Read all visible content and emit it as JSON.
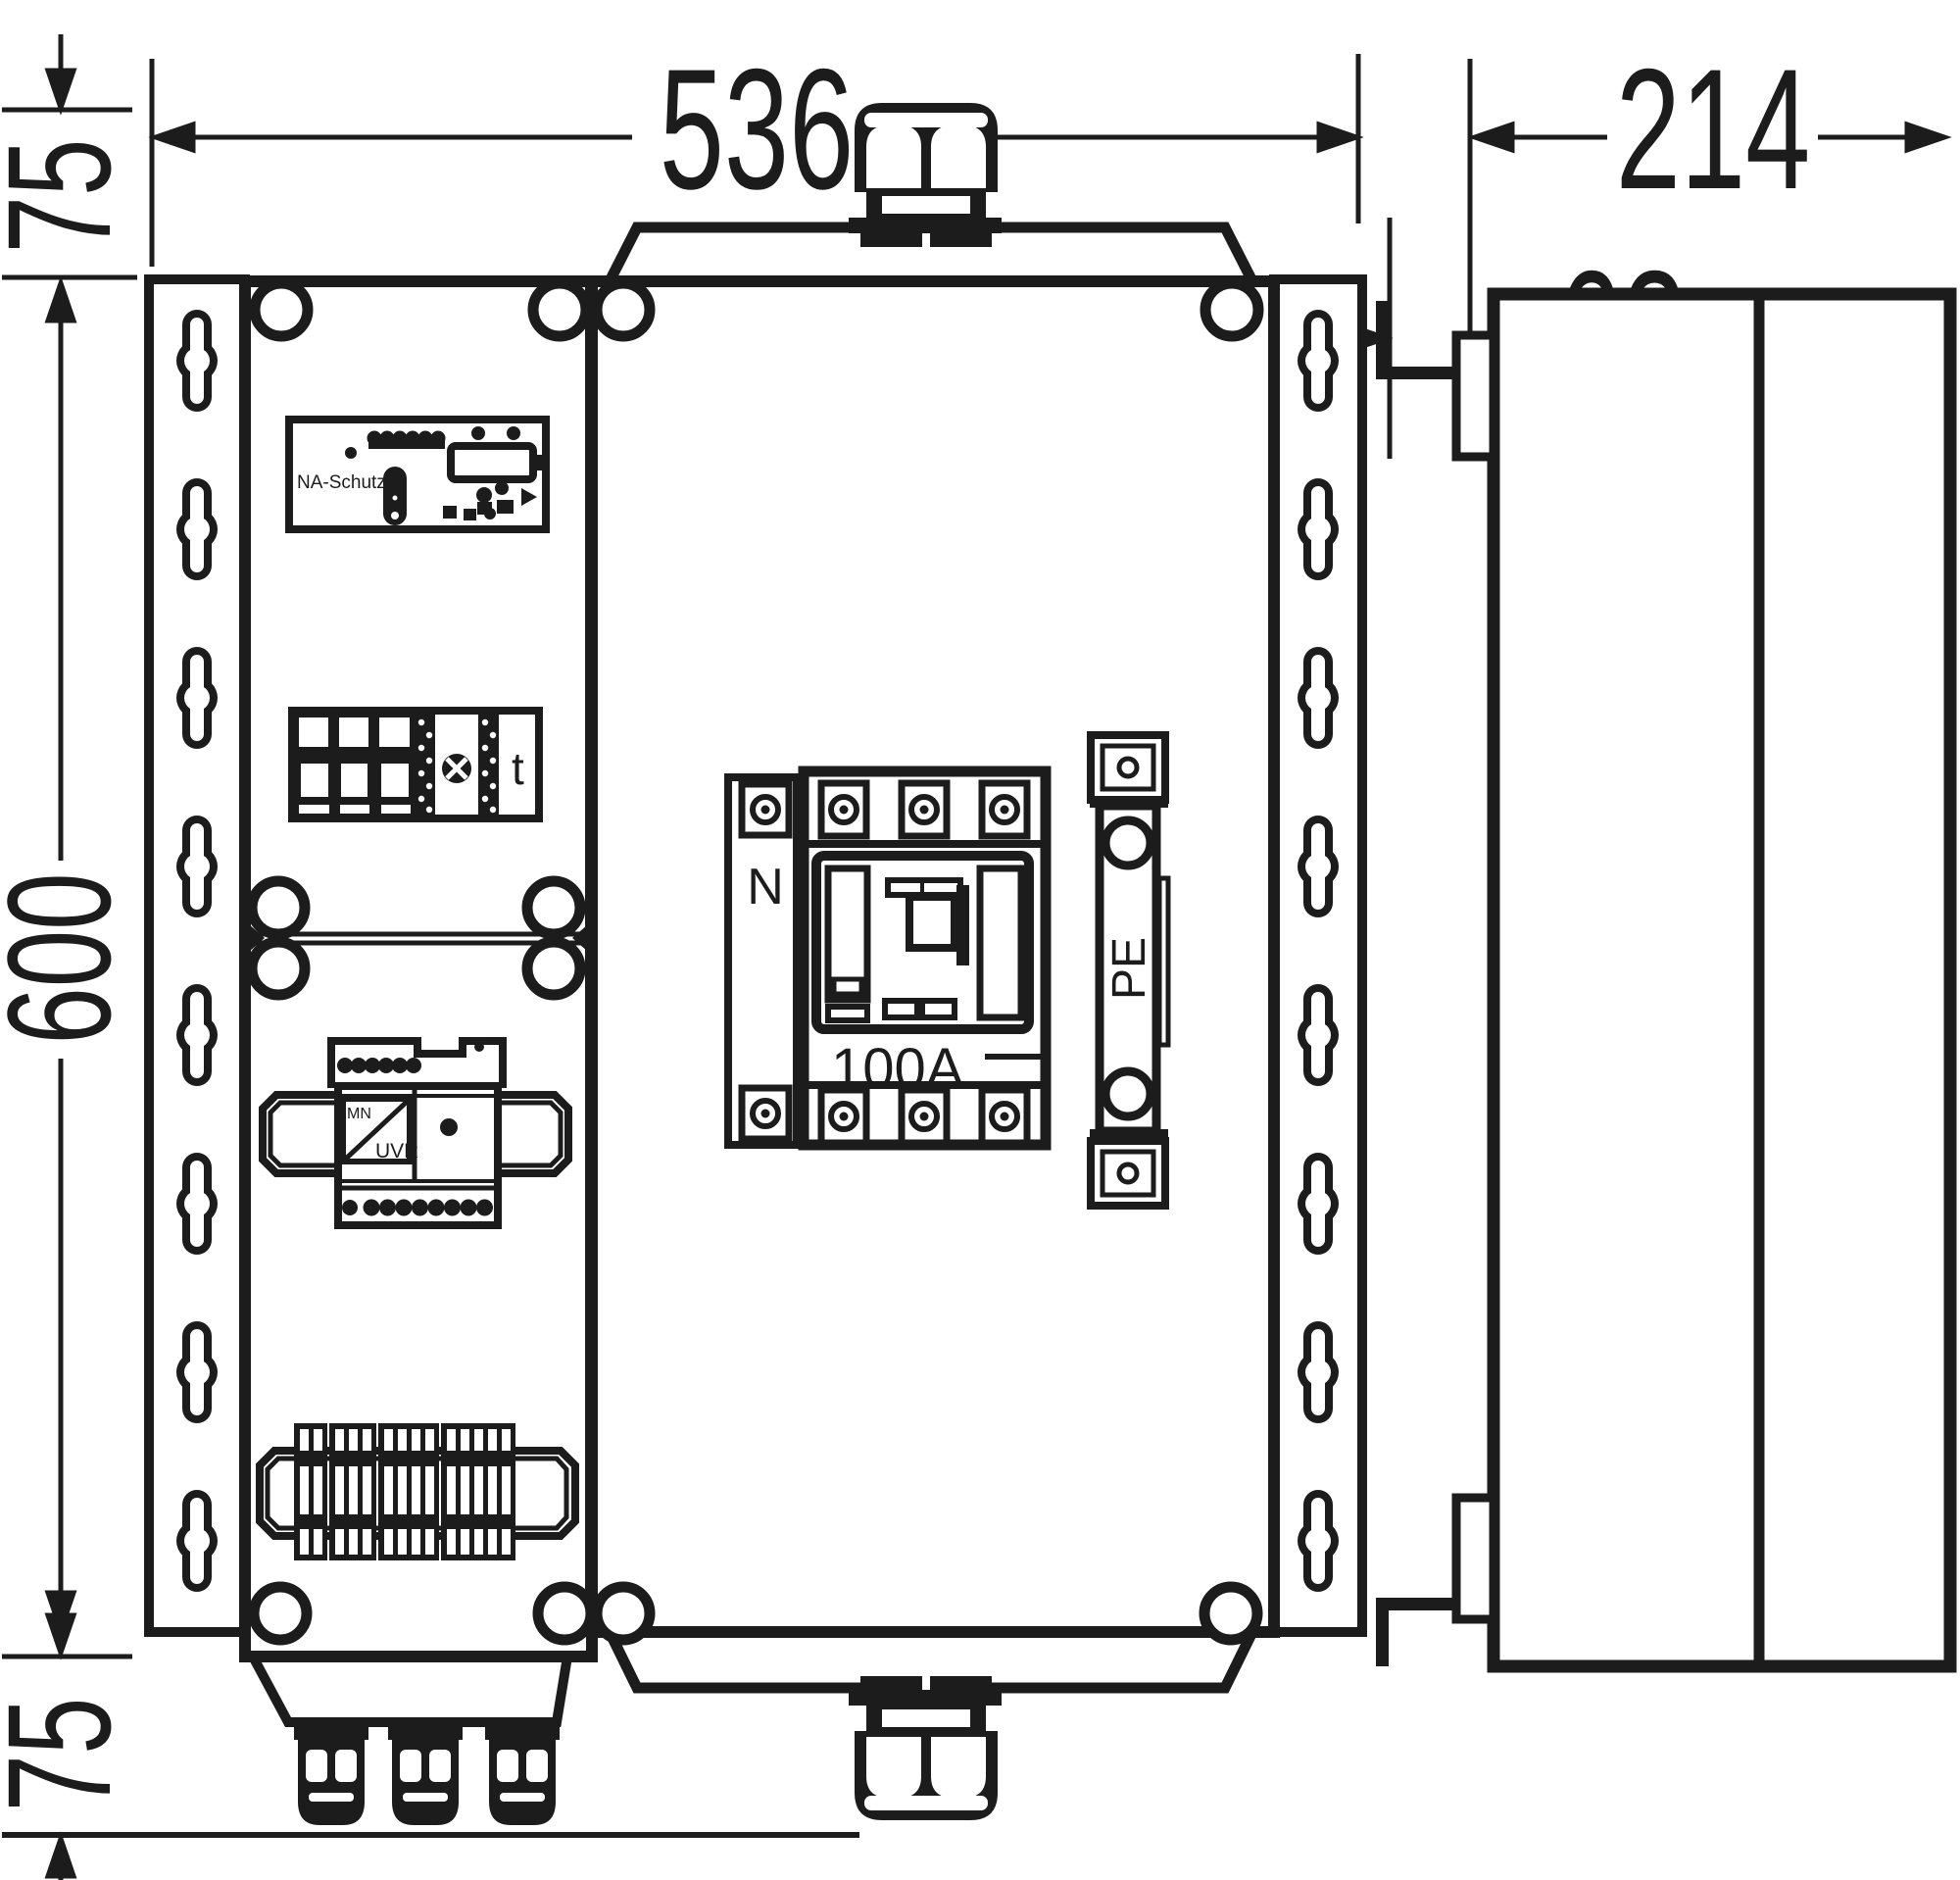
{
  "drawing": {
    "dimensions": {
      "overall_width": "536",
      "side_depth": "214",
      "cover_depth": "62",
      "top_gland_height": "75",
      "overall_height": "600",
      "bottom_gland_height": "75"
    },
    "labels": {
      "na_schutz": "NA-Schutz",
      "timer": "t",
      "mn": "MN",
      "uvr": "UVR",
      "neutral": "N",
      "switch_rating": "100A",
      "pe": "PE"
    },
    "colors": {
      "line": "#1c1c1c",
      "background": "#ffffff"
    }
  }
}
